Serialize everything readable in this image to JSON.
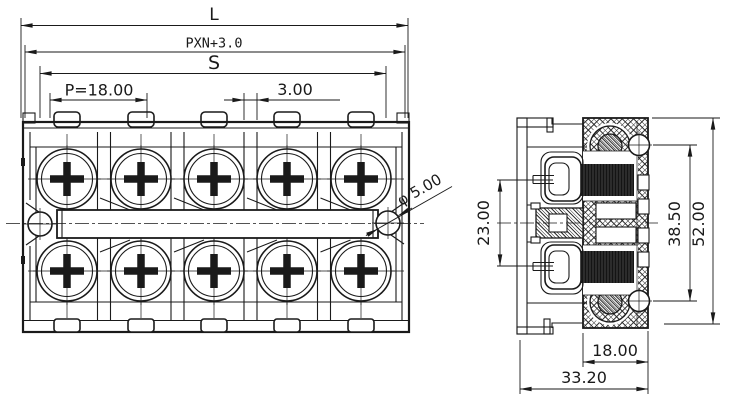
{
  "colors": {
    "line": "#1a1a1a",
    "background": "#ffffff"
  },
  "front_view": {
    "poles": 5,
    "rows": 2,
    "dims": {
      "overall": "L",
      "formula": "PXN+3.0",
      "span": "S",
      "pitch": "P=18.00",
      "gap": "3.00",
      "hole": "φ 5.00"
    }
  },
  "side_view": {
    "dims": {
      "screw_spacing": "23.00",
      "hole_spacing": "38.50",
      "height": "52.00",
      "body_width": "18.00",
      "overall_width": "33.20"
    }
  }
}
